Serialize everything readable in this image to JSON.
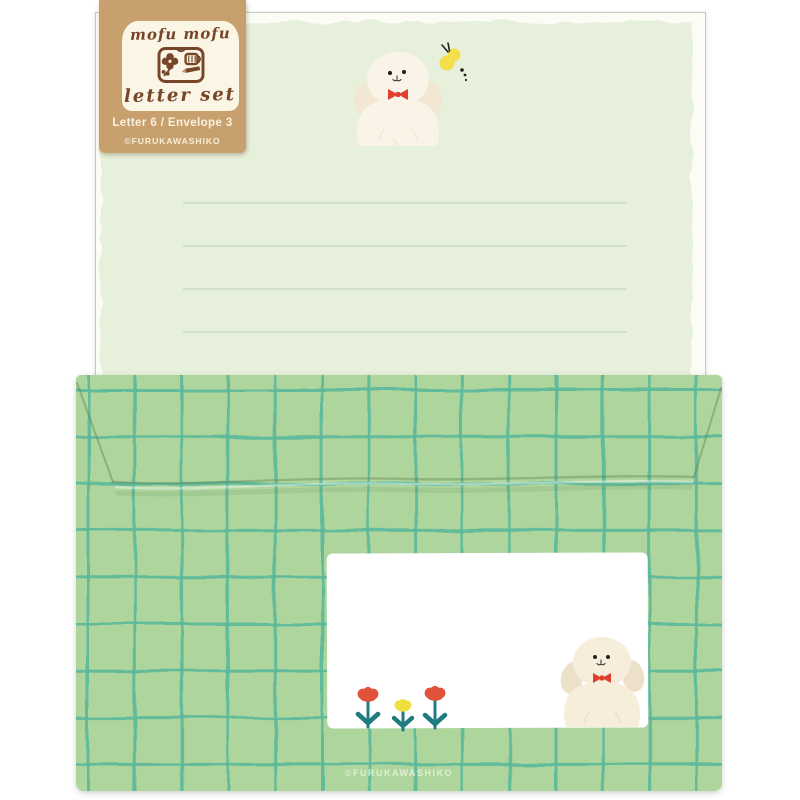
{
  "tag": {
    "brand": "mofu mofu",
    "product": "letter set",
    "contents": "Letter 6 / Envelope 3",
    "copyright": "©FURUKAWASHIKO"
  },
  "envelope": {
    "copyright": "©FURUKAWASHIKO"
  },
  "motifs": {
    "letter_paper": "ruled mint writing paper with fluffy white puppy and yellow butterfly",
    "envelope": "green hand-drawn grid envelope with white address label, tulips and fluffy white puppy"
  },
  "palette": {
    "kraft": "#c8a06e",
    "panel_cream": "#faf5e4",
    "brown": "#774628",
    "tag_light": "#f8f2e0",
    "paper_white": "#fbfcf5",
    "paper_wash": "#e6f0db",
    "rule_line": "#c6d5bf",
    "envelope_green": "#aed59c",
    "grid_teal": "#5cb99c",
    "label_white": "#ffffff",
    "dog_cream": "#faf4e8",
    "dog_cream_dark": "#f1e7d2",
    "dog_cream2": "#f6eeda",
    "dog_cream2_dark": "#ece1c8",
    "bow_red": "#e23f2e",
    "butterfly_yellow": "#f2df49",
    "flower_red": "#e0523a",
    "flower_yellow": "#eee13f",
    "stem_teal": "#1f7b80",
    "env_copyright": "#eaf4e0"
  }
}
